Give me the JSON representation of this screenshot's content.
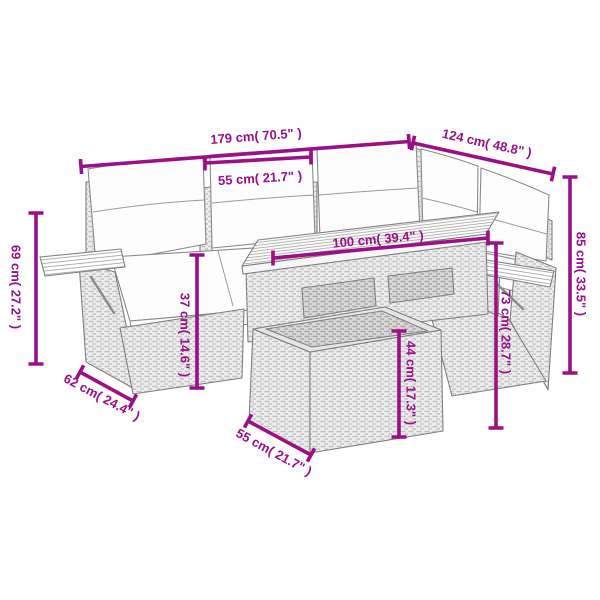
{
  "diagram": {
    "type": "product-dimension-diagram",
    "subject": "poly rattan corner sofa set with slatted table, fold-out side shelves and ottoman",
    "accent_color": "#9b1088",
    "line_color": "#808080",
    "units": "cm / inches",
    "dimensions": {
      "total_width": {
        "label": "179 cm( 70.5\" )"
      },
      "seat_width": {
        "label": "55 cm( 21.7\" )"
      },
      "total_depth": {
        "label": "124 cm( 48.8\" )"
      },
      "table_length": {
        "label": "100 cm( 39.4\" )"
      },
      "back_height": {
        "label": "85 cm( 33.5\" )"
      },
      "right_side_height": {
        "label": "73 cm( 28.7\" )"
      },
      "left_side_height": {
        "label": "69 cm( 27.2\" )"
      },
      "seat_height": {
        "label": "37 cm( 14.6\" )"
      },
      "ottoman_height": {
        "label": "44 cm( 17.3\" )"
      },
      "side_depth": {
        "label": "62 cm( 24.4\" )"
      },
      "ottoman_width": {
        "label": "55 cm( 21.7\" )"
      }
    }
  }
}
